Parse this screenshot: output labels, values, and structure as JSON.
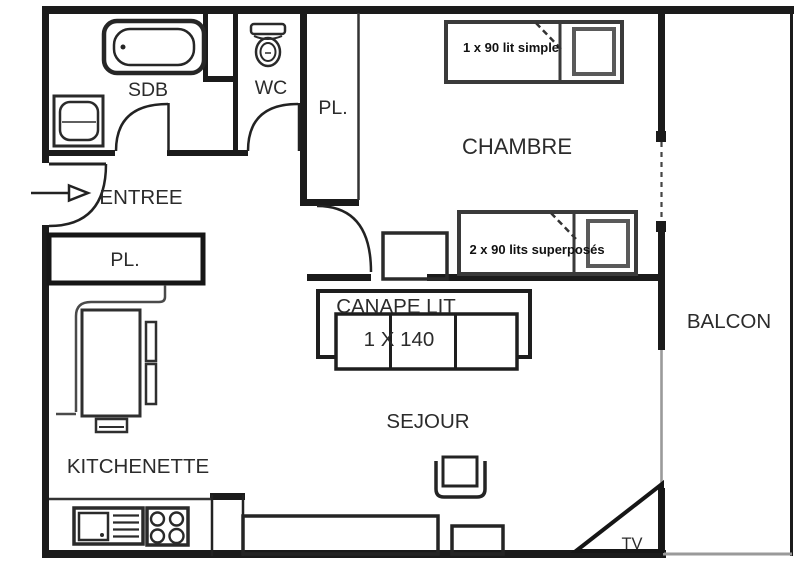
{
  "plan": {
    "rooms": {
      "sdb": "SDB",
      "wc": "WC",
      "entree": "ENTREE",
      "closet_entry": "PL.",
      "closet_hall": "PL.",
      "chambre": "CHAMBRE",
      "sejour": "SEJOUR",
      "kitchenette": "KITCHENETTE",
      "balcon": "BALCON",
      "tv_corner": "TV"
    },
    "beds": {
      "single": "1 x 90 lit simple",
      "bunk": "2 x 90 lits superposés"
    },
    "sofa": {
      "name": "CANAPE LIT",
      "size": "1 X 140"
    },
    "colors": {
      "wall": "#1b1b1b",
      "furniture": "#2f2f2f",
      "window_gray": "#9a9a9a",
      "background": "#ffffff"
    }
  }
}
